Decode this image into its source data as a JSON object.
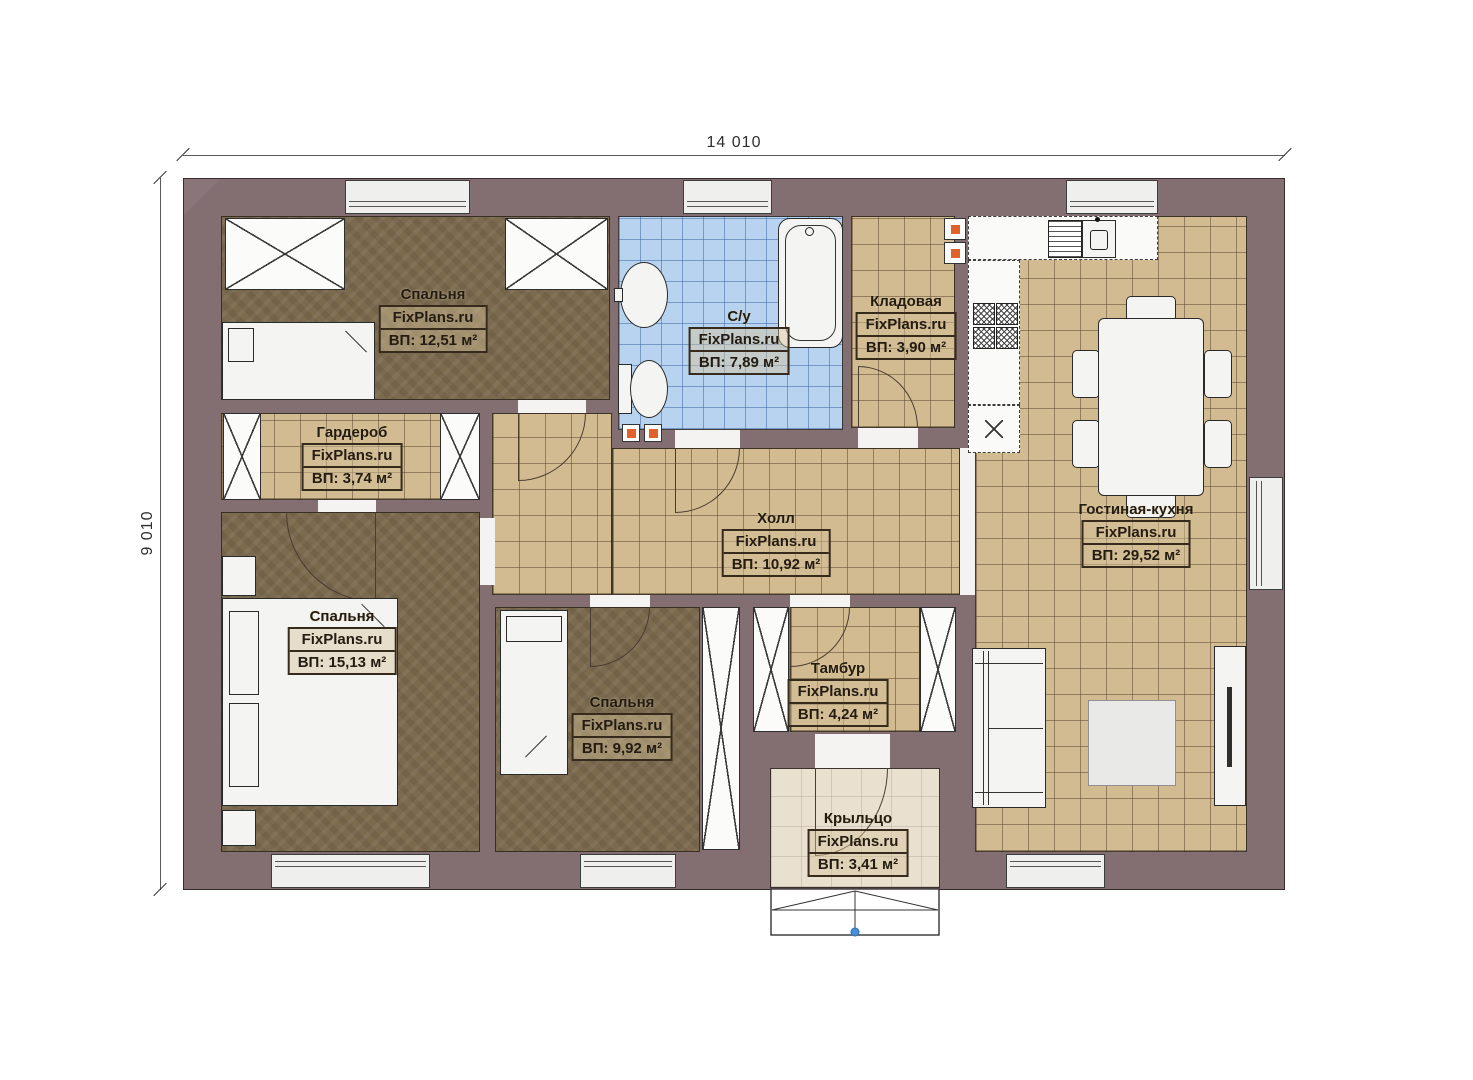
{
  "plan": {
    "dimension_width_label": "14 010",
    "dimension_height_label": "9 010",
    "watermark": "FixPlans.ru"
  },
  "rooms": [
    {
      "id": "bedroom-top",
      "name": "Спальня",
      "area": "ВП: 12,51 м²"
    },
    {
      "id": "bathroom",
      "name": "С/у",
      "area": "ВП: 7,89 м²"
    },
    {
      "id": "pantry",
      "name": "Кладовая",
      "area": "ВП: 3,90 м²"
    },
    {
      "id": "living-kitchen",
      "name": "Гостиная-кухня",
      "area": "ВП: 29,52 м²"
    },
    {
      "id": "wardrobe-room",
      "name": "Гардероб",
      "area": "ВП: 3,74 м²"
    },
    {
      "id": "hall",
      "name": "Холл",
      "area": "ВП: 10,92 м²"
    },
    {
      "id": "bedroom-left",
      "name": "Спальня",
      "area": "ВП: 15,13 м²"
    },
    {
      "id": "bedroom-middle",
      "name": "Спальня",
      "area": "ВП: 9,92 м²"
    },
    {
      "id": "vestibule",
      "name": "Тамбур",
      "area": "ВП: 4,24 м²"
    },
    {
      "id": "porch",
      "name": "Крыльцо",
      "area": "ВП: 3,41 м²"
    }
  ],
  "colors": {
    "wall": "#836e72",
    "tile_floor": "#d2bb90",
    "bathroom_tile": "#b8d3ef",
    "bedroom_floor": "#7b6a4e",
    "porch_floor": "#e9e0cf",
    "accent_orange": "#e0622a",
    "step_marker_blue": "#4a90d9"
  }
}
